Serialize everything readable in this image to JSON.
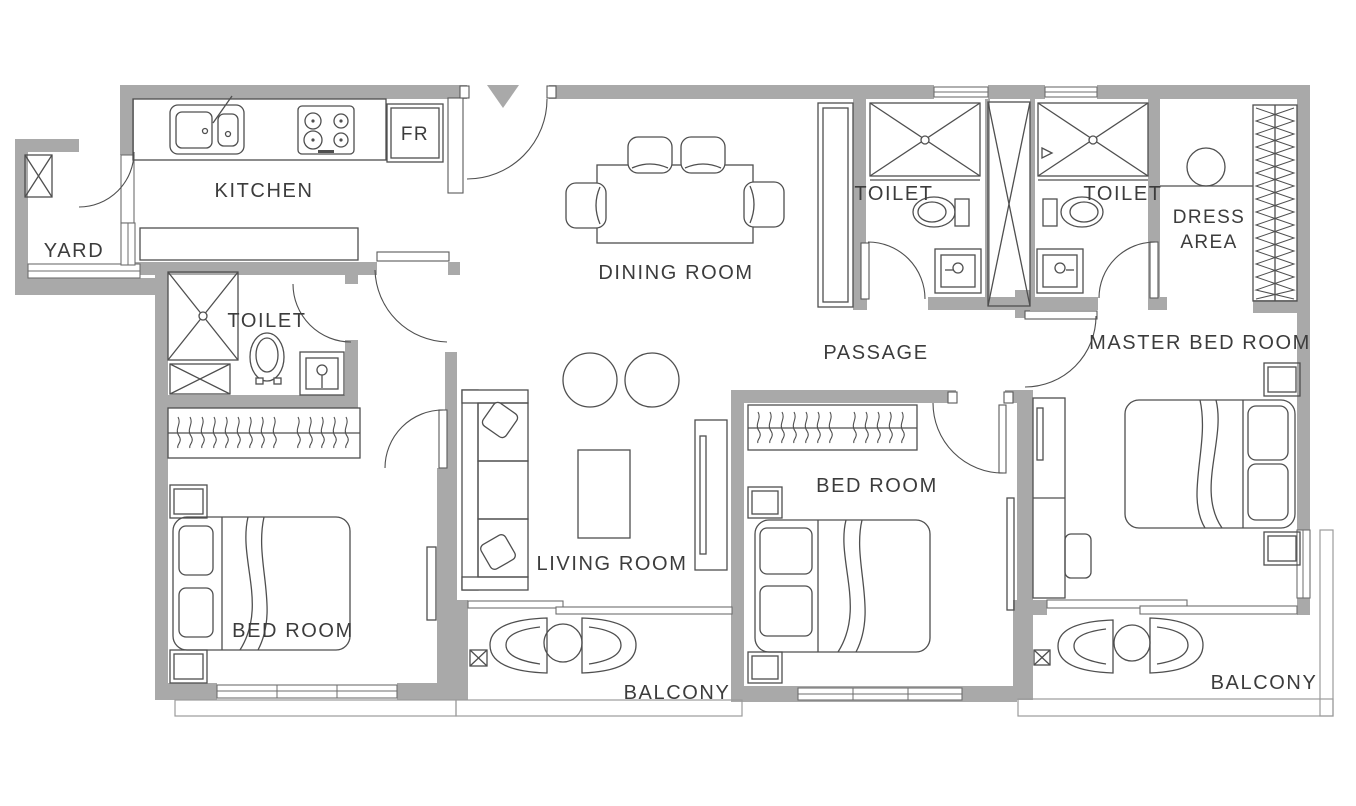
{
  "meta": {
    "type": "apartment-floor-plan"
  },
  "colors": {
    "wall": "#a9a9a9",
    "line": "#4f4f4f",
    "label": "#3c3c3c",
    "outline": "#9b9b9b",
    "background": "#ffffff"
  },
  "rooms": {
    "kitchen": {
      "label": "KITCHEN"
    },
    "yard": {
      "label": "YARD"
    },
    "toilet1": {
      "label": "TOILET"
    },
    "dining": {
      "label": "DINING ROOM"
    },
    "toilet2": {
      "label": "TOILET"
    },
    "toilet3": {
      "label": "TOILET"
    },
    "dress": {
      "line1": "DRESS",
      "line2": "AREA"
    },
    "passage": {
      "label": "PASSAGE"
    },
    "master": {
      "label": "MASTER BED ROOM"
    },
    "living": {
      "label": "LIVING ROOM"
    },
    "bedroom1": {
      "label": "BED ROOM"
    },
    "bedroom2": {
      "label": "BED ROOM"
    },
    "balcony1": {
      "label": "BALCONY"
    },
    "balcony2": {
      "label": "BALCONY"
    },
    "fridge": {
      "label": "FR"
    }
  }
}
